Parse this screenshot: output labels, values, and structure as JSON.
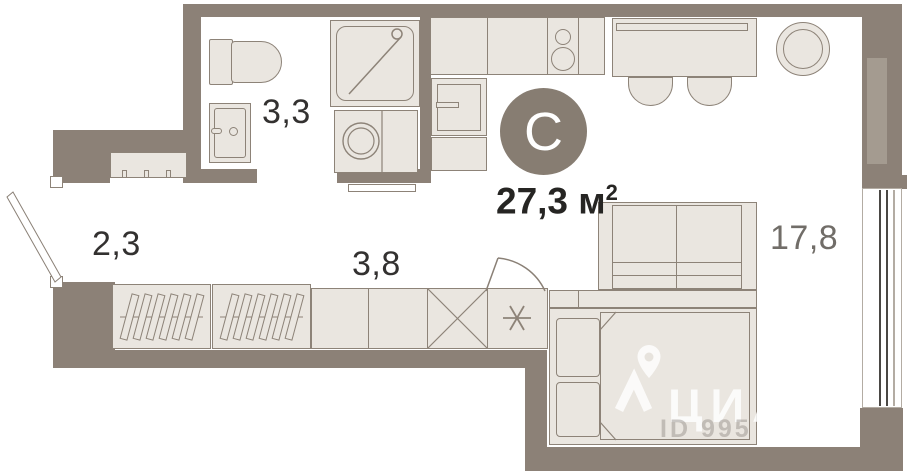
{
  "plan": {
    "type_badge": "С",
    "total_area": "27,3",
    "unit_base": "м",
    "unit_sup": "2",
    "rooms": [
      {
        "id": "bathroom",
        "area": "3,3"
      },
      {
        "id": "loggia",
        "area": "2,3"
      },
      {
        "id": "hallway",
        "area": "3,8"
      },
      {
        "id": "living-room",
        "area": "17,8"
      }
    ]
  },
  "watermark": {
    "brand": "ЦИАН",
    "listing_id": "ID 995"
  },
  "colors": {
    "wall": "#8c8177",
    "furniture_fill": "#eae6e0",
    "furniture_stroke": "#8d8378",
    "badge_circle": "#877d72",
    "label_dark": "#333130",
    "label_gray": "#716d68",
    "floor": "#ffffff"
  }
}
